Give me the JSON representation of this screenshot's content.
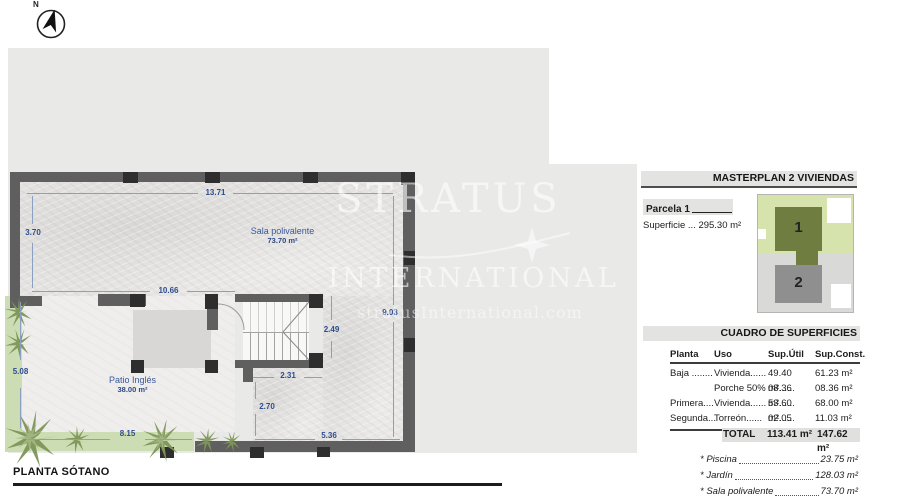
{
  "compass": {
    "label": "N"
  },
  "plan": {
    "title": "PLANTA SÓTANO",
    "rooms": {
      "sala": {
        "name": "Sala polivalente",
        "area": "73.70 m²"
      },
      "patio": {
        "name": "Patio Inglés",
        "area": "38.00 m²"
      }
    },
    "dimensions": {
      "top": "13.71",
      "left": "3.70",
      "mid": "10.66",
      "right": "9.03",
      "stair_h": "2.49",
      "stair_w": "2.31",
      "lower": "2.70",
      "garden_v": "5.08",
      "garden_h": "8.15",
      "bottom_right": "5.36"
    }
  },
  "watermark": {
    "line1": "STRATUS",
    "line2": "INTERNATIONAL",
    "line3": "stratusInternational.com"
  },
  "masterplan": {
    "title": "MASTERPLAN 2 VIVIENDAS",
    "parcela_label": "Parcela 1",
    "superficie": "Superficie ... 295.30 m²",
    "units": [
      {
        "number": "1"
      },
      {
        "number": "2"
      }
    ]
  },
  "surfaces": {
    "title": "CUADRO DE SUPERFICIES",
    "columns": [
      "Planta",
      "Uso",
      "Sup.Útil",
      "Sup.Const."
    ],
    "rows": [
      {
        "planta": "Baja ........",
        "uso": "Vivienda......",
        "util": "49.40 m²......",
        "constr": "61.23 m²"
      },
      {
        "planta": "",
        "uso": "Porche 50%",
        "util": "08.36 m²......",
        "constr": "08.36 m²"
      },
      {
        "planta": "Primera....",
        "uso": "Vivienda......",
        "util": "53.60 m²......",
        "constr": "68.00 m²"
      },
      {
        "planta": "Segunda...",
        "uso": "Torreón......",
        "util": "02.05 m²......",
        "constr": "11.03 m²"
      }
    ],
    "total": {
      "label": "TOTAL",
      "util": "113.41 m²",
      "constr": "147.62 m²"
    },
    "extras": [
      {
        "name": "* Piscina",
        "value": "23.75 m²"
      },
      {
        "name": "* Jardín",
        "value": "128.03 m²"
      },
      {
        "name": "* Sala polivalente",
        "value": "73.70 m²"
      }
    ]
  },
  "colors": {
    "backdrop": "#e9e9e8",
    "wall": "#5f5f5f",
    "column": "#2e2e2e",
    "dimension_blue": "#2e4d8d",
    "garden_green": "#ccdcb3",
    "site_green_light": "#d6e3ad",
    "site_green_dark": "#6f7e40",
    "site_gray_light": "#d9d9d8",
    "site_gray_dark": "#8f8f8f"
  }
}
